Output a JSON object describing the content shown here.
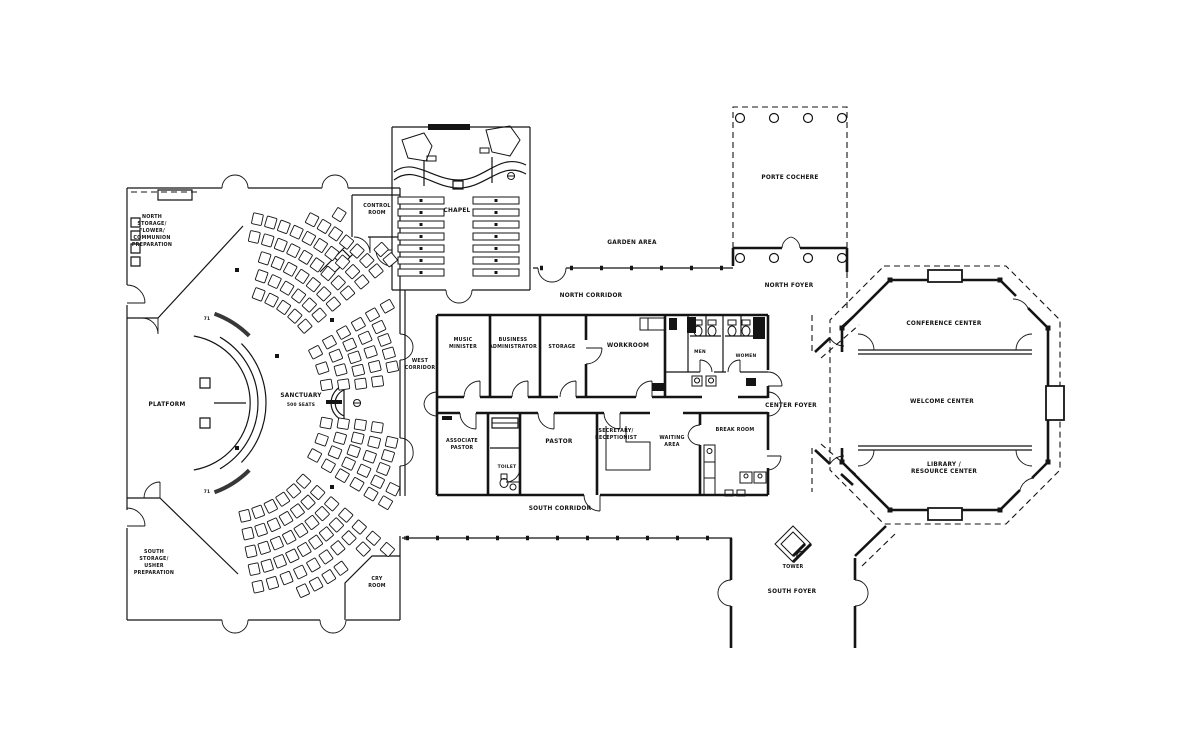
{
  "colors": {
    "ink": "#141414",
    "background": "#ffffff"
  },
  "labels": {
    "north_storage": [
      "NORTH",
      "STORAGE/",
      "FLOWER/",
      "COMMUNION",
      "PREPARATION"
    ],
    "south_storage": [
      "SOUTH",
      "STORAGE/",
      "USHER",
      "PREPARATION"
    ],
    "control_room": [
      "CONTROL",
      "ROOM"
    ],
    "cry_room": [
      "CRY",
      "ROOM"
    ],
    "platform": "PLATFORM",
    "sanctuary": "SANCTUARY",
    "sanctuary_note": "500 SEATS",
    "chapel": "CHAPEL",
    "west_corridor": [
      "WEST",
      "CORRIDOR"
    ],
    "north_corridor": "NORTH CORRIDOR",
    "south_corridor": "SOUTH CORRIDOR",
    "garden_area": "GARDEN AREA",
    "music_minister": [
      "MUSIC",
      "MINISTER"
    ],
    "business_admin": [
      "BUSINESS",
      "ADMINISTRATOR"
    ],
    "storage": "STORAGE",
    "workroom": "WORKROOM",
    "men": "MEN",
    "women": "WOMEN",
    "associate_pastor": [
      "ASSOCIATE",
      "PASTOR"
    ],
    "toilet": "TOILET",
    "pastor": "PASTOR",
    "secretary": [
      "SECRETARY/",
      "RECEPTIONIST"
    ],
    "waiting_area": [
      "WAITING",
      "AREA"
    ],
    "break_room": "BREAK ROOM",
    "porte_cochere": "PORTE COCHERE",
    "north_foyer": "NORTH FOYER",
    "center_foyer": "CENTER FOYER",
    "south_foyer": "SOUTH FOYER",
    "tower": "TOWER",
    "conference_center": "CONFERENCE CENTER",
    "welcome_center": "WELCOME CENTER",
    "library": [
      "LIBRARY /",
      "RESOURCE CENTER"
    ],
    "marker_a": "71",
    "marker_b": "71"
  },
  "plan": {
    "sanctuary_seating": {
      "center": {
        "x": 218,
        "y": 403
      },
      "seat": {
        "w": 10,
        "h": 11
      },
      "sections": [
        {
          "name": "north",
          "a1": -80,
          "a2": -38,
          "radii": [
            116,
            134,
            152,
            170,
            188,
            206,
            224,
            242
          ]
        },
        {
          "name": "north-center",
          "a1": -32,
          "a2": -5,
          "radii": [
            110,
            127,
            144,
            161,
            178,
            195
          ]
        },
        {
          "name": "south-center",
          "a1": 6,
          "a2": 33,
          "radii": [
            110,
            127,
            144,
            161,
            178,
            195
          ]
        },
        {
          "name": "south",
          "a1": 39,
          "a2": 80,
          "radii": [
            116,
            134,
            152,
            170,
            188,
            206,
            224,
            242
          ]
        }
      ]
    },
    "chapel_pews": {
      "rows": 7,
      "y0": 197,
      "dy": 12,
      "h": 7,
      "cols": [
        {
          "x": 398,
          "w": 46
        },
        {
          "x": 473,
          "w": 46
        }
      ]
    }
  }
}
